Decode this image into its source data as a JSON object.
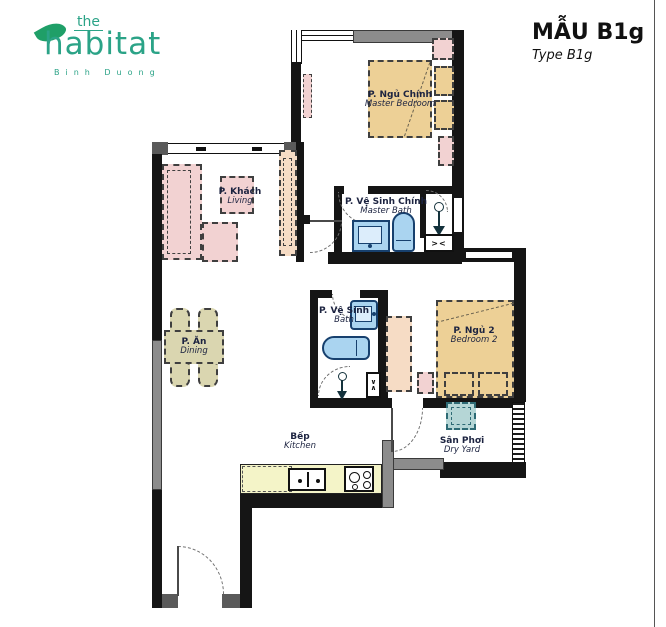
{
  "header": {
    "title": "MẪU B1g",
    "subtitle": "Type B1g"
  },
  "logo": {
    "line1": "the",
    "line2": "habitat",
    "line3": "Binh Duong"
  },
  "rooms": {
    "master_bedroom": {
      "vi": "P. Ngủ Chính",
      "en": "Master Bedroom"
    },
    "living": {
      "vi": "P. Khách",
      "en": "Living"
    },
    "master_bath": {
      "vi": "P. Vệ Sinh Chính",
      "en": "Master Bath"
    },
    "bath": {
      "vi": "P. Vệ Sinh",
      "en": "Bath"
    },
    "bedroom2": {
      "vi": "P. Ngủ 2",
      "en": "Bedroom 2"
    },
    "dining": {
      "vi": "P. Ăn",
      "en": "Dining"
    },
    "kitchen": {
      "vi": "Bếp",
      "en": "Kitchen"
    },
    "dry_yard": {
      "vi": "Sân Phơi",
      "en": "Dry Yard"
    }
  },
  "symbols": {
    "vent_h": "><",
    "vent_v_top": "∨",
    "vent_v_bottom": "∧"
  },
  "colors": {
    "logo_green": "#2BA387",
    "wall_dark": "#151515",
    "wall_gray": "#8C8C8C",
    "bed_tan": "#EDD096",
    "furniture_pink": "#F2D2D2",
    "cabinet_peach": "#F6DCC5",
    "fixture_blue": "#AAD4F0",
    "fixture_outline": "#17406E",
    "washer_teal": "#B5D6D6",
    "counter_yellow": "#F4F4C8",
    "dining_khaki": "#DAD6B0",
    "label_navy": "#1C2340"
  }
}
